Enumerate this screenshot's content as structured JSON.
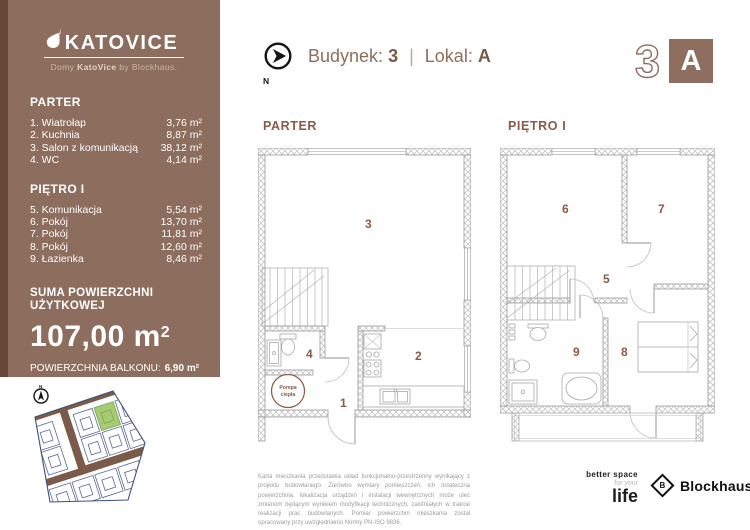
{
  "header": {
    "compass_label": "N",
    "building_label": "Budynek:",
    "building_value": "3",
    "separator": "|",
    "unit_label": "Lokal:",
    "unit_value": "A",
    "mark_number": "3",
    "mark_letter": "A"
  },
  "sidebar": {
    "logo_title": "KATOVICE",
    "logo_subtitle_prefix": "Domy ",
    "logo_subtitle_brand": "KatoVice",
    "logo_subtitle_suffix": " by Blockhaus.",
    "parter": {
      "heading": "PARTER",
      "rooms": [
        {
          "label": "1. Wiatrołap",
          "area": "3,76 m²"
        },
        {
          "label": "2. Kuchnia",
          "area": "8,87 m²"
        },
        {
          "label": "3. Salon z komunikacją",
          "area": "38,12 m²"
        },
        {
          "label": "4. WC",
          "area": "4,14 m²"
        }
      ]
    },
    "pietro": {
      "heading": "PIĘTRO I",
      "rooms": [
        {
          "label": "5. Komunikacja",
          "area": "5,54 m²"
        },
        {
          "label": "6. Pokój",
          "area": "13,70 m²"
        },
        {
          "label": "7. Pokój",
          "area": "11,81 m²"
        },
        {
          "label": "8. Pokój",
          "area": "12,60 m²"
        },
        {
          "label": "9. Łazienka",
          "area": "8,46 m²"
        }
      ]
    },
    "summary_heading": "SUMA POWIERZCHNI UŻYTKOWEJ",
    "summary_value": "107,00 m",
    "summary_sup": "2",
    "balcony_label": "POWIERZCHNIA BALKONU:",
    "balcony_value": "6,90 m²",
    "plot_label": "POWIERZCHNIA DZIAŁKI:",
    "plot_value": "253,00 m²"
  },
  "plans": {
    "parter": {
      "title": "PARTER",
      "labels": {
        "r1": "1",
        "r2": "2",
        "r3": "3",
        "r4": "4"
      },
      "pump_line1": "Pompa",
      "pump_line2": "ciepła"
    },
    "pietro": {
      "title": "PIĘTRO I",
      "labels": {
        "r5": "5",
        "r6": "6",
        "r7": "7",
        "r8": "8",
        "r9": "9"
      }
    }
  },
  "site_plan": {
    "compass_label": "N",
    "highlight_color": "#a7cb73"
  },
  "footer": {
    "disclaimer": "Karta mieszkania przedstawia układ funkcjonalno-przestrzenny wynikający z projektu budowlanego. Zarówno wymiary pomieszczeń, ich ostateczna powierzchnia, lokalizacja urządzeń i instalacji wewnętrznych może ulec zmianom będącym wynikiem modyfikacji technicznych, zaistniałych w trakcie realizacji prac budowlanych. Pomiar powierzchni mieszkania został opracowany przy uwzględnieniu Normy PN-ISO 9836.",
    "tagline_line1": "better space",
    "tagline_line2": "for your",
    "tagline_line3": "life",
    "brand_mark": "B",
    "brand_name": "Blockhaus."
  },
  "colors": {
    "sidebar": "#8c6d5e",
    "sidebar_accent": "#654639",
    "brand_brown": "#8a6b59",
    "room_number": "#8a5a46",
    "plot_green": "#a7cb73",
    "plot_outline": "#5a6a92",
    "road_brown": "#7b5a49"
  }
}
